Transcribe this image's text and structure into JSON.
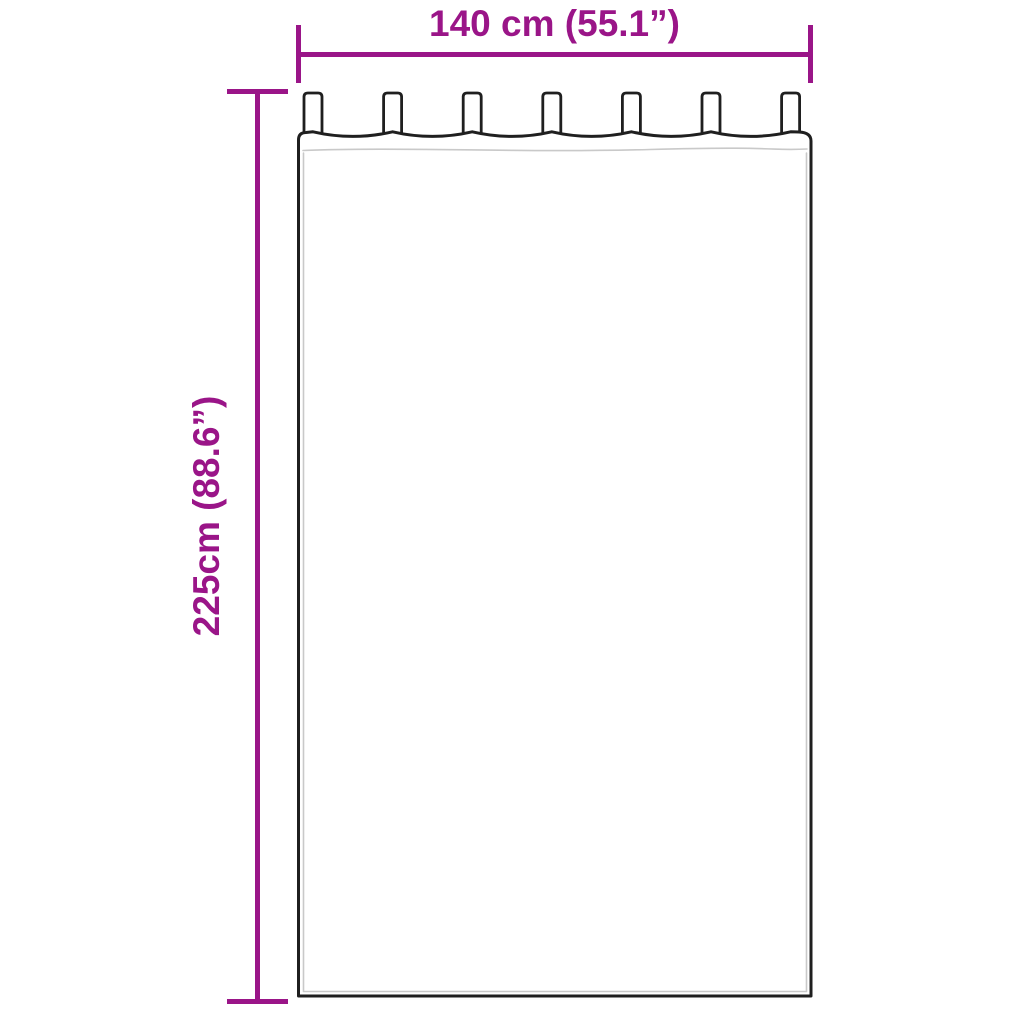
{
  "diagram": {
    "type": "product-dimension-drawing",
    "drawing": {
      "name": "tab-top-curtain-outline",
      "tabs_count": 7
    },
    "width_dimension": {
      "label": "140 cm (55.1”)"
    },
    "height_dimension": {
      "label": "225cm (88.6”)"
    },
    "colors": {
      "dimension": "#9A1588",
      "outline": "#1F1F1F",
      "seam": "#C9C9C9",
      "background": "#FFFFFF"
    }
  }
}
